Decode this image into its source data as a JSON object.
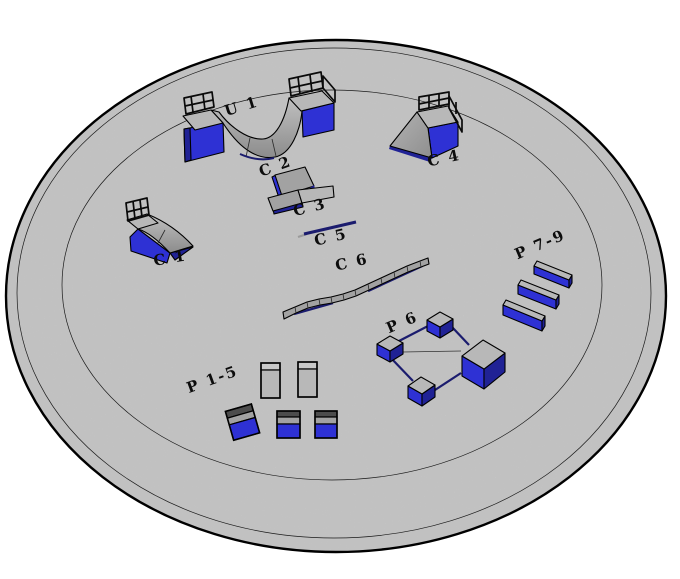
{
  "scene": {
    "description": "3D rendering of a circular skatepark platform with labeled obstacles",
    "ground": {
      "shape": "circular platform",
      "ring_count": 3
    },
    "colors": {
      "background": "#ffffff",
      "platform": "#d5d5d5",
      "outline": "#1a1a1a",
      "obstacle_gray": "#a2a2a2",
      "obstacle_gray_light": "#c9c9c9",
      "obstacle_gray_dark": "#8a8a8a",
      "obstacle_blue": "#2e31d4",
      "obstacle_blue_dark": "#202295",
      "rail_navy": "#1b1c6e",
      "label": "#0c0c0c"
    },
    "obstacles": [
      {
        "id": "u1",
        "label": "U 1",
        "kind": "mini-halfpipe"
      },
      {
        "id": "c1",
        "label": "C 1",
        "kind": "quarterpipe"
      },
      {
        "id": "c2",
        "label": "C 2",
        "kind": "kicker-ramp"
      },
      {
        "id": "c3",
        "label": "C 3",
        "kind": "kicker-ramp"
      },
      {
        "id": "c4",
        "label": "C 4",
        "kind": "bank-ramp-with-rails"
      },
      {
        "id": "c5",
        "label": "C 5",
        "kind": "flat-grind-rail"
      },
      {
        "id": "c6",
        "label": "C 6",
        "kind": "curved-grind-ledge"
      },
      {
        "id": "p6",
        "label": "P 6",
        "kind": "boxes-with-square-rails"
      },
      {
        "id": "p7_9",
        "label": "P 7-9",
        "kind": "grind-ledges"
      },
      {
        "id": "p1_5",
        "label": "P 1-5",
        "kind": "grind-boxes"
      }
    ]
  }
}
